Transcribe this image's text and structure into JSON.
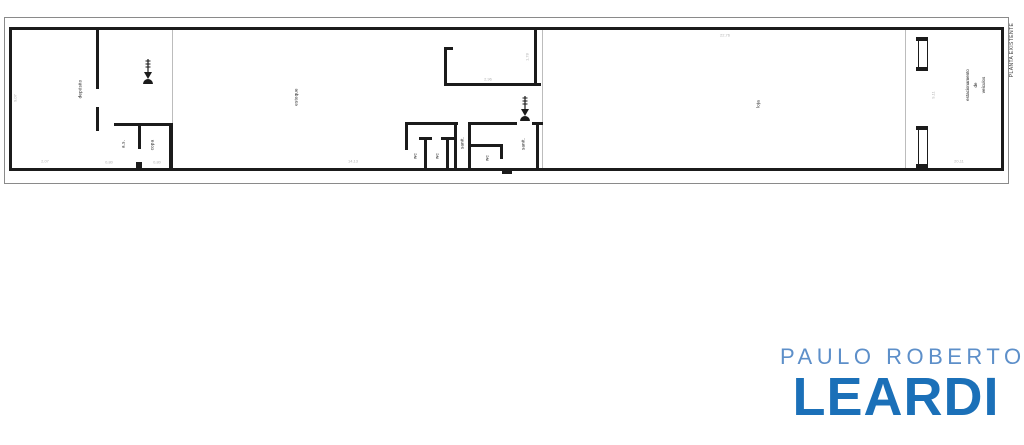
{
  "plan": {
    "sheet_label": "PLANTA EXISTENTE",
    "rooms": {
      "deposito": "depósito",
      "as": "a.s.",
      "copa": "copa",
      "estoque": "estoque",
      "wc1": "wc",
      "wc2": "wc",
      "sanit1": "sanit.",
      "wc3": "wc",
      "sanit2": "sanit.",
      "loja": "loja",
      "estacionamento_l1": "estacionamento",
      "estacionamento_l2": "de",
      "estacionamento_l3": "veículos"
    },
    "dims": {
      "d1": "9,07",
      "d2": "2,07",
      "d3": "0,80",
      "d4": "0,80",
      "d5": "14,13",
      "d6": "2,96",
      "d7": "1,78",
      "d8": "22,76",
      "d9": "9,11",
      "d10": "20,11"
    },
    "line_color": "#1b1b1b",
    "section_line_color": "#bcbcbc",
    "dim_color": "#b3b3b3"
  },
  "logo": {
    "line1": "PAULO ROBERTO",
    "line2": "LEARDI",
    "line1_color": "#5d8fc9",
    "line2_color": "#1b70b8"
  }
}
